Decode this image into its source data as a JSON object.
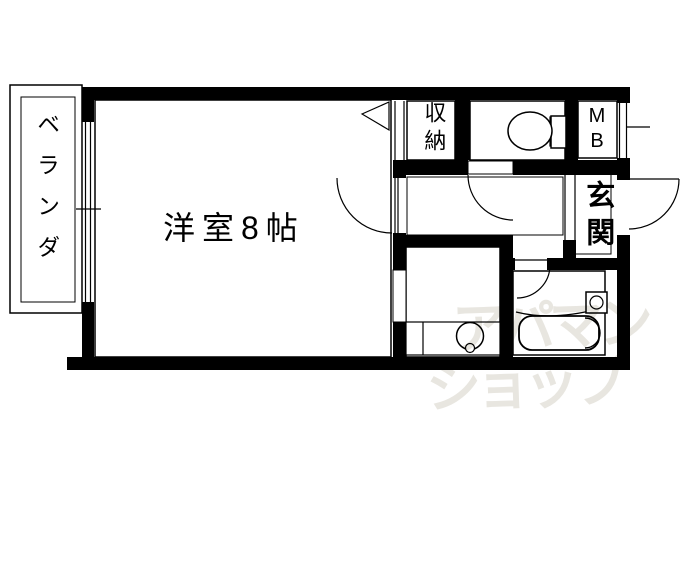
{
  "rooms": {
    "balcony": {
      "label": "ベランダ"
    },
    "main_room": {
      "label": "洋室8帖"
    },
    "closet": {
      "label": "収納"
    },
    "meter_box": {
      "label": "M\nB"
    },
    "entrance": {
      "label": "玄関"
    }
  },
  "watermark": {
    "line1": "アパマン",
    "line2": "ショップ"
  },
  "fixtures": {
    "toilet": "toilet-icon",
    "bathtub": "bathtub-icon",
    "washbasin": "washbasin-icon",
    "bath_faucet": "faucet-icon"
  },
  "colors": {
    "wall": "#000000",
    "line": "#000000",
    "background": "#ffffff",
    "watermark": "#e8e6e0"
  }
}
